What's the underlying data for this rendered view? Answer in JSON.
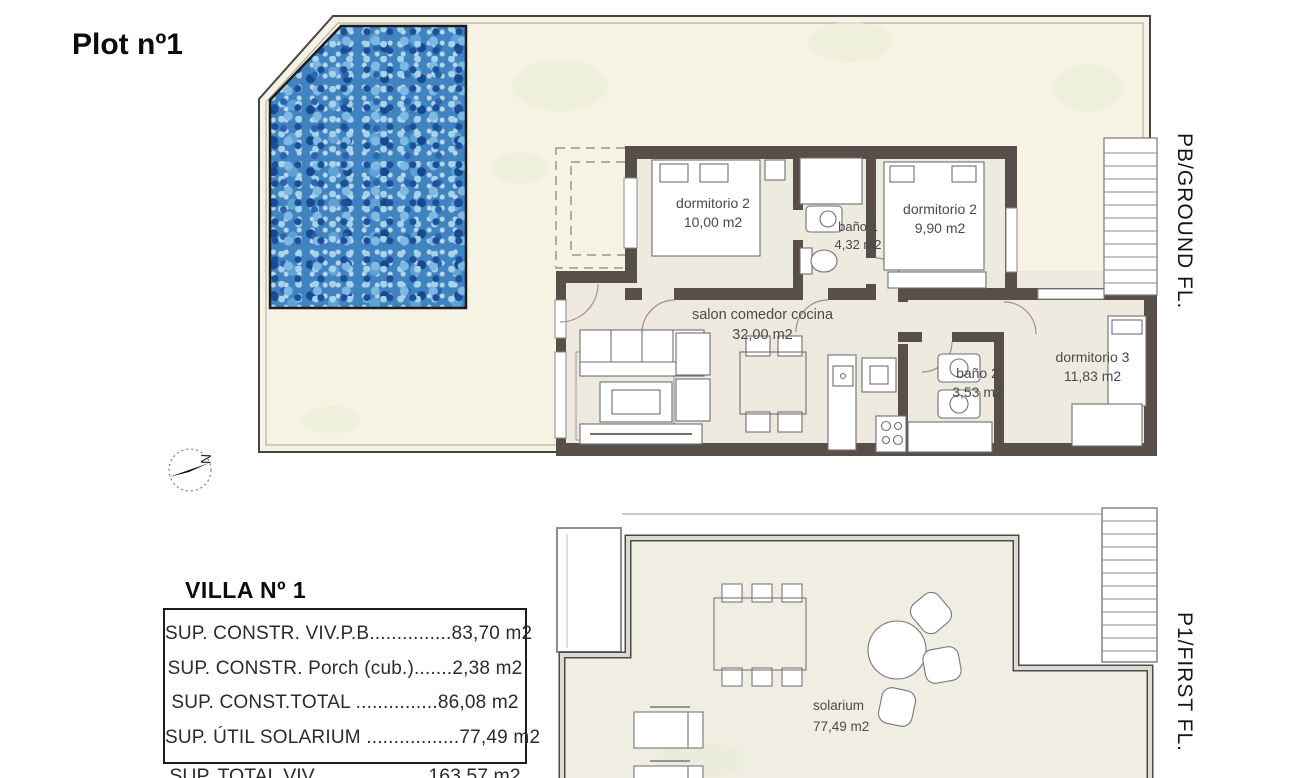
{
  "title": "Plot nº1",
  "ground_floor": {
    "side_label": "PB/GROUND FL.",
    "compass_letter": "N",
    "rooms": [
      {
        "name": "dormitorio 2",
        "area": "10,00 m2"
      },
      {
        "name": "baño 1",
        "area": "4,32 m2"
      },
      {
        "name": "dormitorio 2",
        "area": "9,90 m2"
      },
      {
        "name": "salon comedor cocina",
        "area": "32,00 m2"
      },
      {
        "name": "baño 2",
        "area": "3,53 m2"
      },
      {
        "name": "dormitorio 3",
        "area": "11,83 m2"
      }
    ]
  },
  "first_floor": {
    "side_label": "P1/FIRST FL.",
    "rooms": [
      {
        "name": "solarium",
        "area": "77,49 m2"
      }
    ]
  },
  "summary": {
    "title": "VILLA Nº 1",
    "rows": [
      {
        "label": "SUP. CONSTR. VIV.P.B",
        "dots": "...............",
        "value": "83,70 m2"
      },
      {
        "label": "SUP. CONSTR. Porch (cub.)",
        "dots": ".......",
        "value": "2,38 m2"
      },
      {
        "label": "SUP. CONST.TOTAL ",
        "dots": "...............",
        "value": "86,08 m2"
      },
      {
        "label": "SUP. ÚTIL SOLARIUM ",
        "dots": ".................",
        "value": "77,49 m2"
      }
    ],
    "total": {
      "label": "SUP. TOTAL VIV ",
      "dots": "....................",
      "value": "163,57 m2"
    }
  },
  "colors": {
    "wall": "#584f4a",
    "terrace": "#f6f3e4",
    "interior": "#edeadf",
    "pool_base": "#3f83c0",
    "stain_green": "#e7ecd4"
  }
}
